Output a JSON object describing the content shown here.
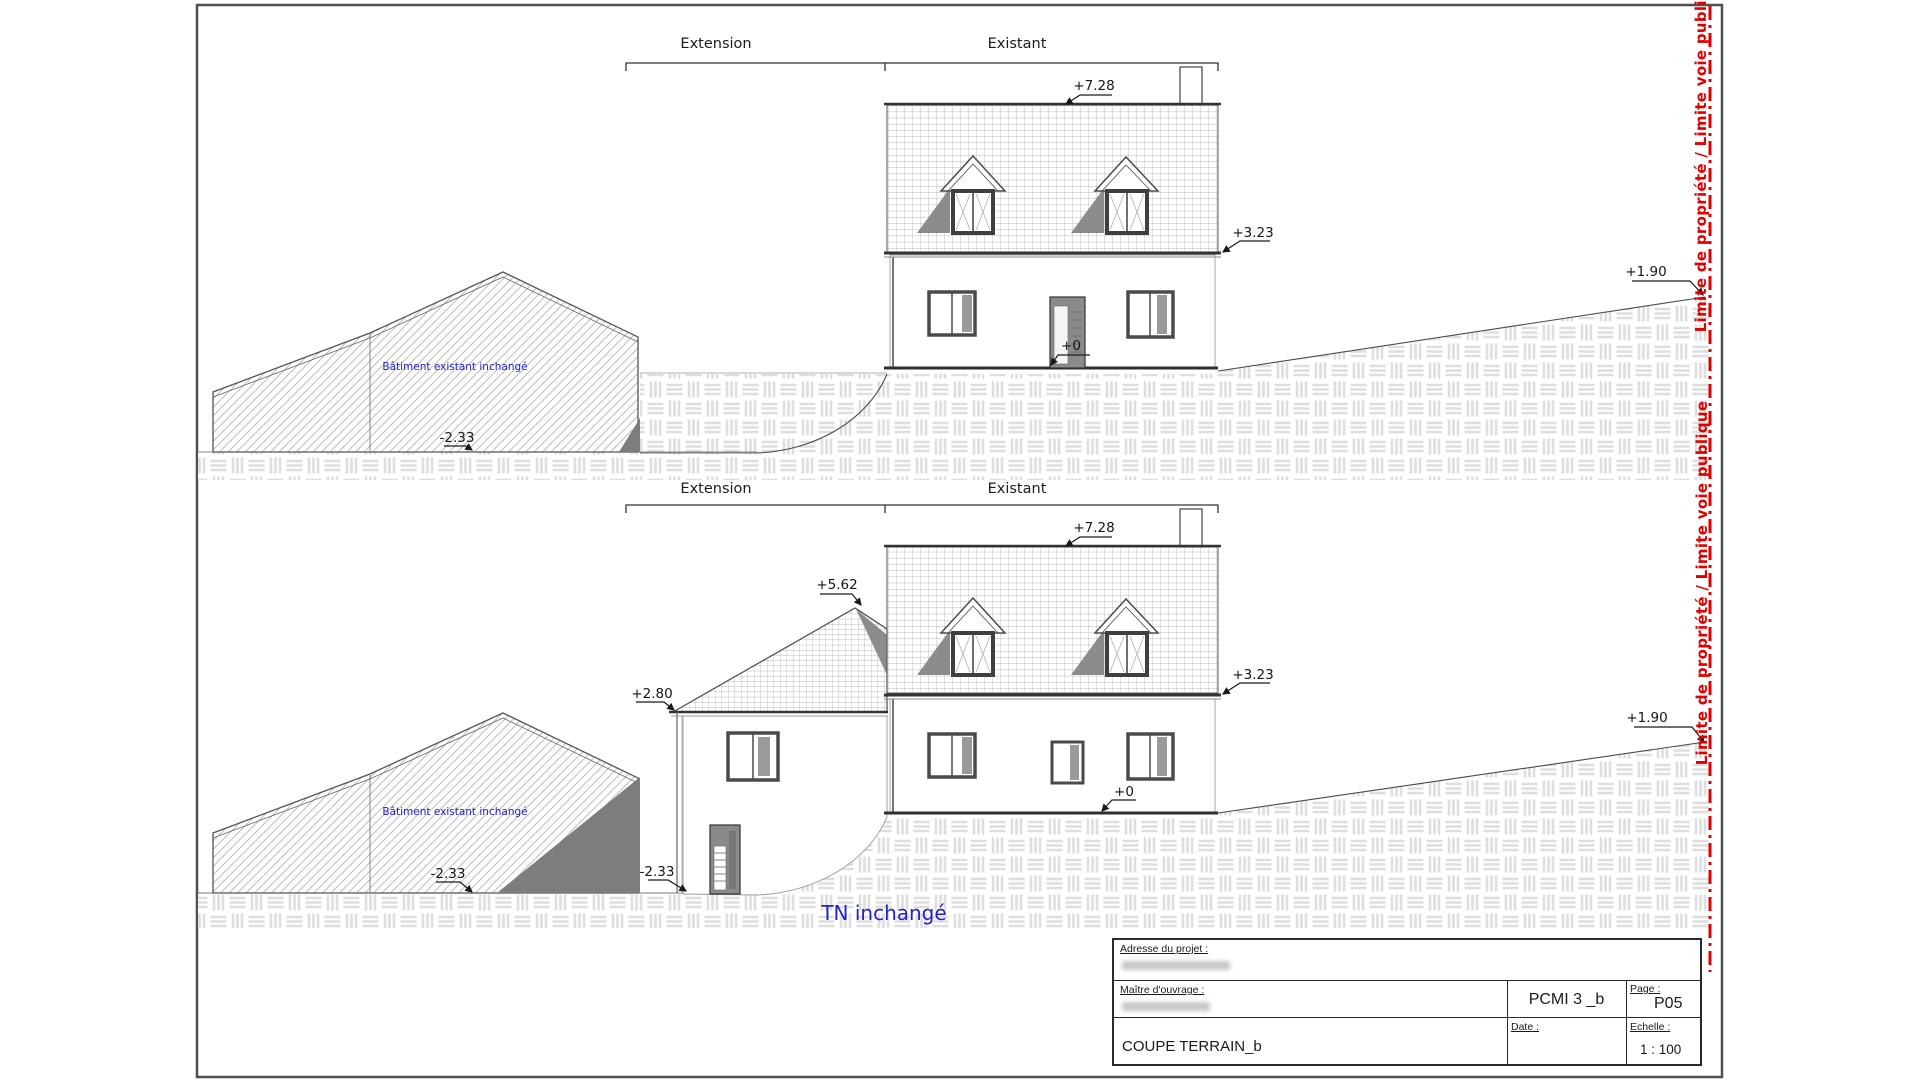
{
  "colors": {
    "boundary_red": "#e10000",
    "note_blue": "#2121cc",
    "line_dark": "#333333",
    "shadow_gray": "#8c8c8c",
    "hatch_light": "#dedede"
  },
  "top_view": {
    "extension_label": "Extension",
    "existant_label": "Existant",
    "dim_ridge": "+7.28",
    "dim_eave": "+3.23",
    "dim_zero": "+0",
    "dim_barn": "-2.33",
    "dim_boundary": "+1.90",
    "barn_note": "Bâtiment existant inchangé"
  },
  "bottom_view": {
    "extension_label": "Extension",
    "existant_label": "Existant",
    "dim_ridge": "+7.28",
    "dim_eave": "+3.23",
    "dim_zero": "+0",
    "dim_ext_ridge": "+5.62",
    "dim_ext_eave": "+2.80",
    "dim_barn": "-2.33",
    "dim_door": "-2.33",
    "dim_boundary": "+1.90",
    "barn_note": "Bâtiment existant inchangé",
    "terrain_note": "TN inchangé"
  },
  "boundary_label": "Limite de propriété / Limite voie publique",
  "title_block": {
    "address_label": "Adresse du projet :",
    "owner_label": "Maître d'ouvrage :",
    "drawing_title": "COUPE TERRAIN_b",
    "reference": "PCMI 3 _b",
    "page_label": "Page :",
    "page_value": "P05",
    "date_label": "Date :",
    "scale_label": "Echelle :",
    "scale_value": "1 : 100"
  }
}
